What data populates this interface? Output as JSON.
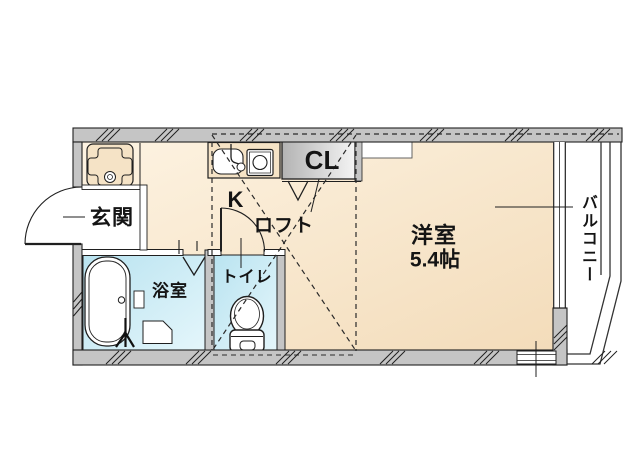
{
  "labels": {
    "entrance": "玄関",
    "bathroom": "浴室",
    "toilet": "トイレ",
    "kitchen": "K",
    "loft": "ロフト",
    "closet": "CL",
    "western_room": "洋室",
    "western_room_size": "5.4帖",
    "balcony": "バルコニー"
  },
  "colors": {
    "wall": "#c5c5c5",
    "outline": "#1f1f1f",
    "floor_light": "#fcf1de",
    "floor_dark": "#f3dcba",
    "wet_area_dark": "#b9e3f0",
    "wet_area_light": "#e4f6fb",
    "closet_dark": "#b3b3b3",
    "closet_light": "#f2f2f2"
  }
}
